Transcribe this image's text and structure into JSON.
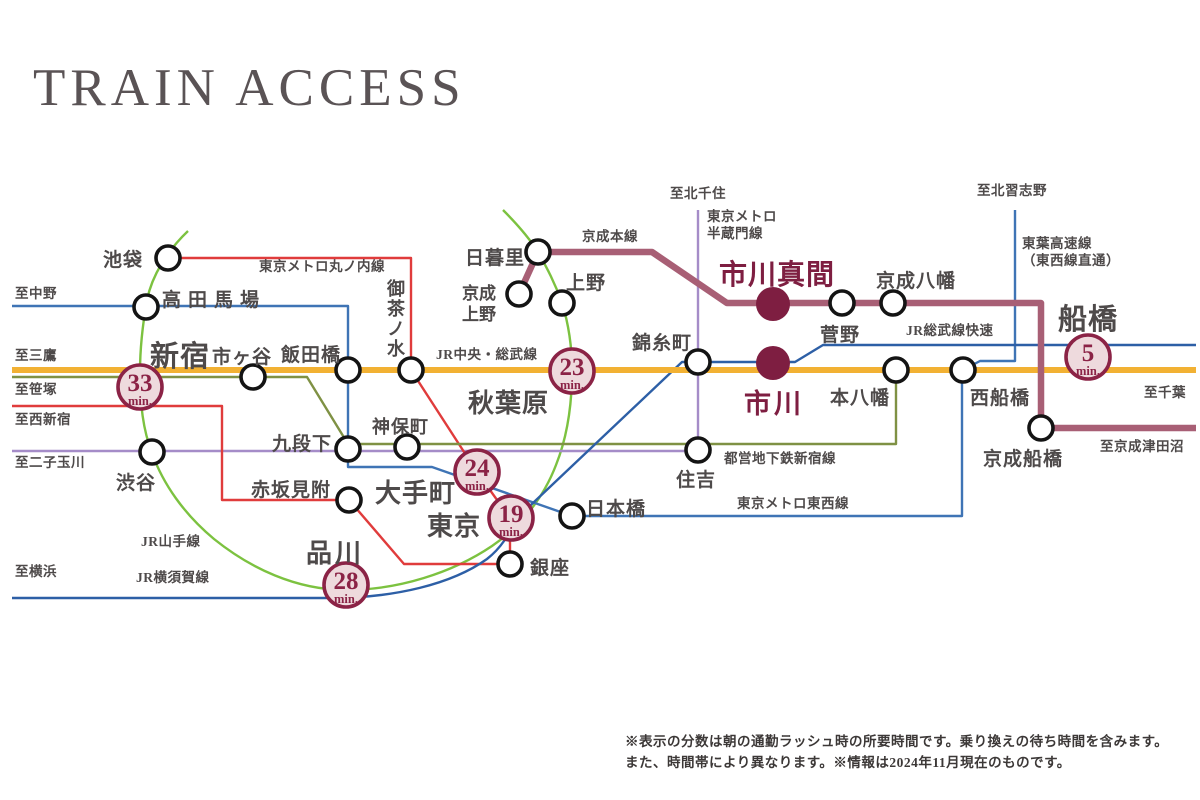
{
  "title": "TRAIN ACCESS",
  "colors": {
    "jr_chuo_sobu_local": "#f2b133",
    "jr_yamanote": "#7cc240",
    "jr_rapid_yokosuka": "#2d5fa6",
    "metro_tozai_toyo": "#3f74b5",
    "metro_marunouchi": "#e03c3c",
    "metro_hanzomon": "#a58cc8",
    "toei_shinjuku": "#7f9144",
    "keisei_main": "#a85f75",
    "feature_wine": "#7e1e41",
    "badge_border": "#8b2346",
    "badge_fill": "#eedadd",
    "station_text": "#4e4a4a",
    "title_text": "#5a5355"
  },
  "line_labels": {
    "marunouchi": "東京メトロ丸ノ内線",
    "chuo_sobu": "JR中央・総武線",
    "keisei_main": "京成本線",
    "hanzomon_1": "東京メトロ",
    "hanzomon_2": "半蔵門線",
    "sobu_rapid": "JR総武線快速",
    "toyo_1": "東葉高速線",
    "toyo_2": "（東西線直通）",
    "yamanote": "JR山手線",
    "yokosuka": "JR横須賀線",
    "toei_shinjuku": "都営地下鉄新宿線",
    "tozai": "東京メトロ東西線"
  },
  "stations": {
    "ikebukuro": "池袋",
    "takadanobaba": "高田馬場",
    "shinjuku": "新宿",
    "ichigaya": "市ヶ谷",
    "iidabashi": "飯田橋",
    "ochanomizu": "御茶ノ水",
    "akihabara": "秋葉原",
    "nippori": "日暮里",
    "keisei_ueno_1": "京成",
    "keisei_ueno_2": "上野",
    "ueno": "上野",
    "kinshicho": "錦糸町",
    "jimbocho": "神保町",
    "kudanshita": "九段下",
    "akasakamitsuke": "赤坂見附",
    "shibuya": "渋谷",
    "otemachi": "大手町",
    "tokyo": "東京",
    "ginza": "銀座",
    "nihombashi": "日本橋",
    "sumiyoshi": "住吉",
    "shinagawa": "品川",
    "sugano": "菅野",
    "keisei_yawata": "京成八幡",
    "motoyawata": "本八幡",
    "nishifunabashi": "西船橋",
    "keisei_funabashi": "京成船橋",
    "funabashi": "船橋",
    "ichikawamama": "市川真間",
    "ichikawa": "市川"
  },
  "badges": {
    "shinjuku": {
      "value": "33",
      "unit": "min."
    },
    "akihabara": {
      "value": "23",
      "unit": "min."
    },
    "otemachi": {
      "value": "24",
      "unit": "min."
    },
    "tokyo": {
      "value": "19",
      "unit": "min."
    },
    "shinagawa": {
      "value": "28",
      "unit": "min."
    },
    "funabashi": {
      "value": "5",
      "unit": "min."
    }
  },
  "edges": {
    "nakano": "至中野",
    "mitaka": "至三鷹",
    "sasazuka": "至笹塚",
    "nishishinjuku": "至西新宿",
    "futakotamagawa": "至二子玉川",
    "yokohama": "至横浜",
    "kitasenju": "至北千住",
    "kitanarashino": "至北習志野",
    "chiba": "至千葉",
    "keiseitsudanuma": "至京成津田沼"
  },
  "notes": {
    "line1": "※表示の分数は朝の通勤ラッシュ時の所要時間です。乗り換えの待ち時間を含みます。",
    "line2": "また、時間帯により異なります。※情報は2024年11月現在のものです。"
  }
}
